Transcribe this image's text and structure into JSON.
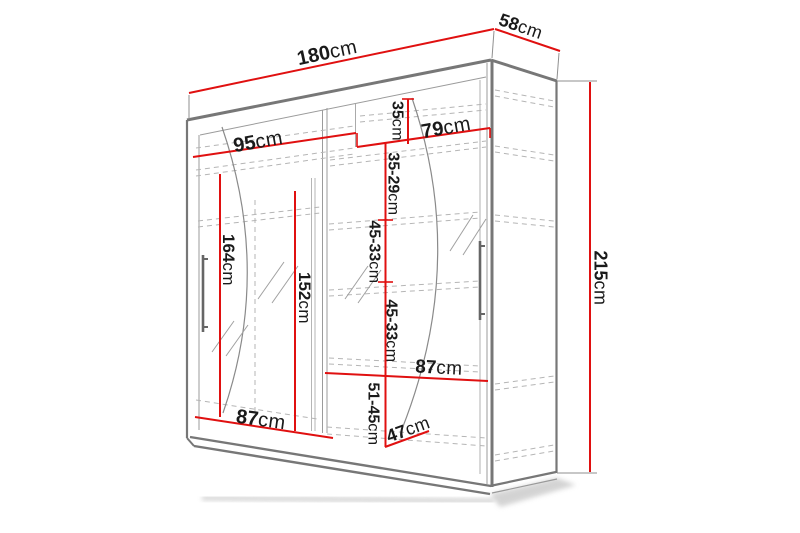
{
  "figure": {
    "kind": "wardrobe-dimension-diagram",
    "unit": "cm"
  },
  "colors": {
    "dimension_line": "#e01010",
    "outline_dark": "#777777",
    "outline_light": "#9b9b9b",
    "dashed_line": "#b5b5b5",
    "label_text": "#1a1a1a",
    "background": "#ffffff"
  },
  "dimensions": {
    "total_width": {
      "value": "180",
      "unit": "cm"
    },
    "depth": {
      "value": "58",
      "unit": "cm"
    },
    "total_height": {
      "value": "215",
      "unit": "cm"
    },
    "left_section_width": {
      "value": "95",
      "unit": "cm"
    },
    "right_section_width": {
      "value": "79",
      "unit": "cm"
    },
    "top_right_cubby": {
      "value": "35",
      "unit": "cm"
    },
    "shelf_gap_1": {
      "value": "35-29",
      "unit": "cm"
    },
    "shelf_gap_2": {
      "value": "45-33",
      "unit": "cm"
    },
    "shelf_gap_3": {
      "value": "45-33",
      "unit": "cm"
    },
    "shelf_gap_4": {
      "value": "51-45",
      "unit": "cm"
    },
    "left_hanging_height": {
      "value": "164",
      "unit": "cm"
    },
    "left_inner_height": {
      "value": "152",
      "unit": "cm"
    },
    "left_bottom_width": {
      "value": "87",
      "unit": "cm"
    },
    "right_shelf_width": {
      "value": "87",
      "unit": "cm"
    },
    "inner_depth": {
      "value": "47",
      "unit": "cm"
    }
  }
}
